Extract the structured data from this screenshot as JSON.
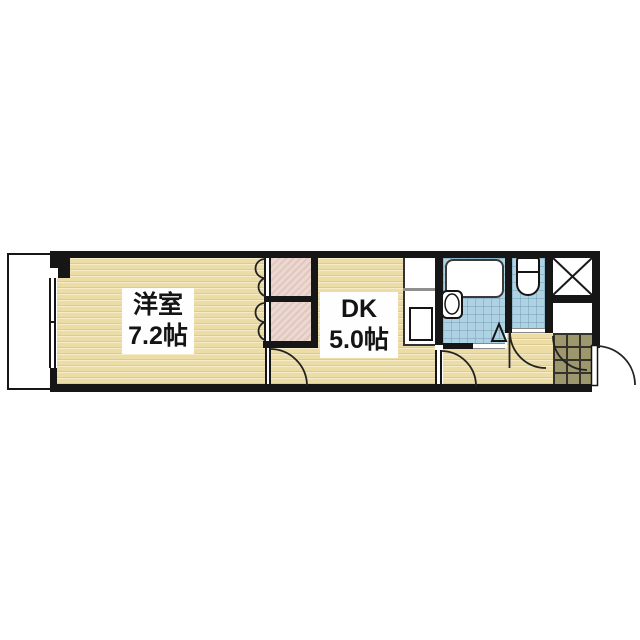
{
  "page": {
    "kind": "floor-plan",
    "background": "#ffffff"
  },
  "rooms": {
    "western_room": {
      "name": "洋室",
      "size": "7.2帖"
    },
    "dining_kitchen": {
      "name": "DK",
      "size": "5.0帖"
    }
  },
  "features": {
    "balcony": "balcony-strip",
    "window": "sliding-window",
    "closet": "double-closet-bifold-doors",
    "kitchen": "counter-with-sink",
    "bath": "unit-bath-with-tub-and-washbasin",
    "toilet": "toilet-room",
    "pipe_space": "x-marked-duct-box",
    "entrance": "genkan-with-outward-door"
  },
  "colors": {
    "wall": "#161616",
    "wood_floor": "#ecdca6",
    "wood_grain": "#c7a95e",
    "closet_fill": "#ebd8d0",
    "tile_blue": "#aed2e2",
    "tile_blue_grid": "#76a3bc",
    "genkan_tile": "#9d976d",
    "genkan_grid": "#34322a",
    "label_bg": "#fefefe",
    "text": "#141414"
  }
}
